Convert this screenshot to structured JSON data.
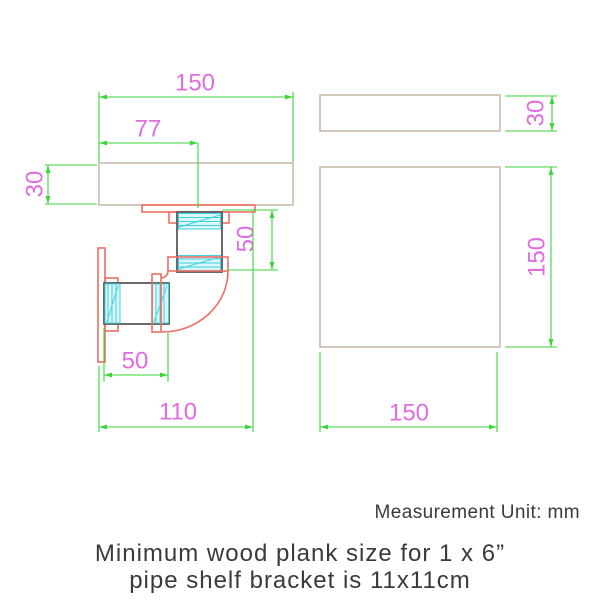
{
  "drawing": {
    "side_view": {
      "plank_width": "150",
      "flange_offset": "77",
      "plank_thickness": "30",
      "vertical_pipe_length": "50",
      "horizontal_pipe_length": "50",
      "bracket_depth": "110"
    },
    "top_view": {
      "plank_thickness": "30",
      "plank_depth": "150",
      "plank_width": "150"
    }
  },
  "notes": {
    "unit_note": "Measurement Unit: mm",
    "caption_line1": "Minimum wood plank size for 1 x 6”",
    "caption_line2": "pipe shelf bracket is 11x11cm"
  },
  "colors": {
    "dimension_line": "#3bd53b",
    "dimension_text": "#df6ddf",
    "outline": "#ef6e63",
    "wood_outline": "#c6bcaa",
    "pipe_thread": "#3fd2e2",
    "pipe_thread_fill": "#dcf6fa",
    "pipe_outline": "#5a5a5a",
    "text": "#3a3a3a"
  }
}
